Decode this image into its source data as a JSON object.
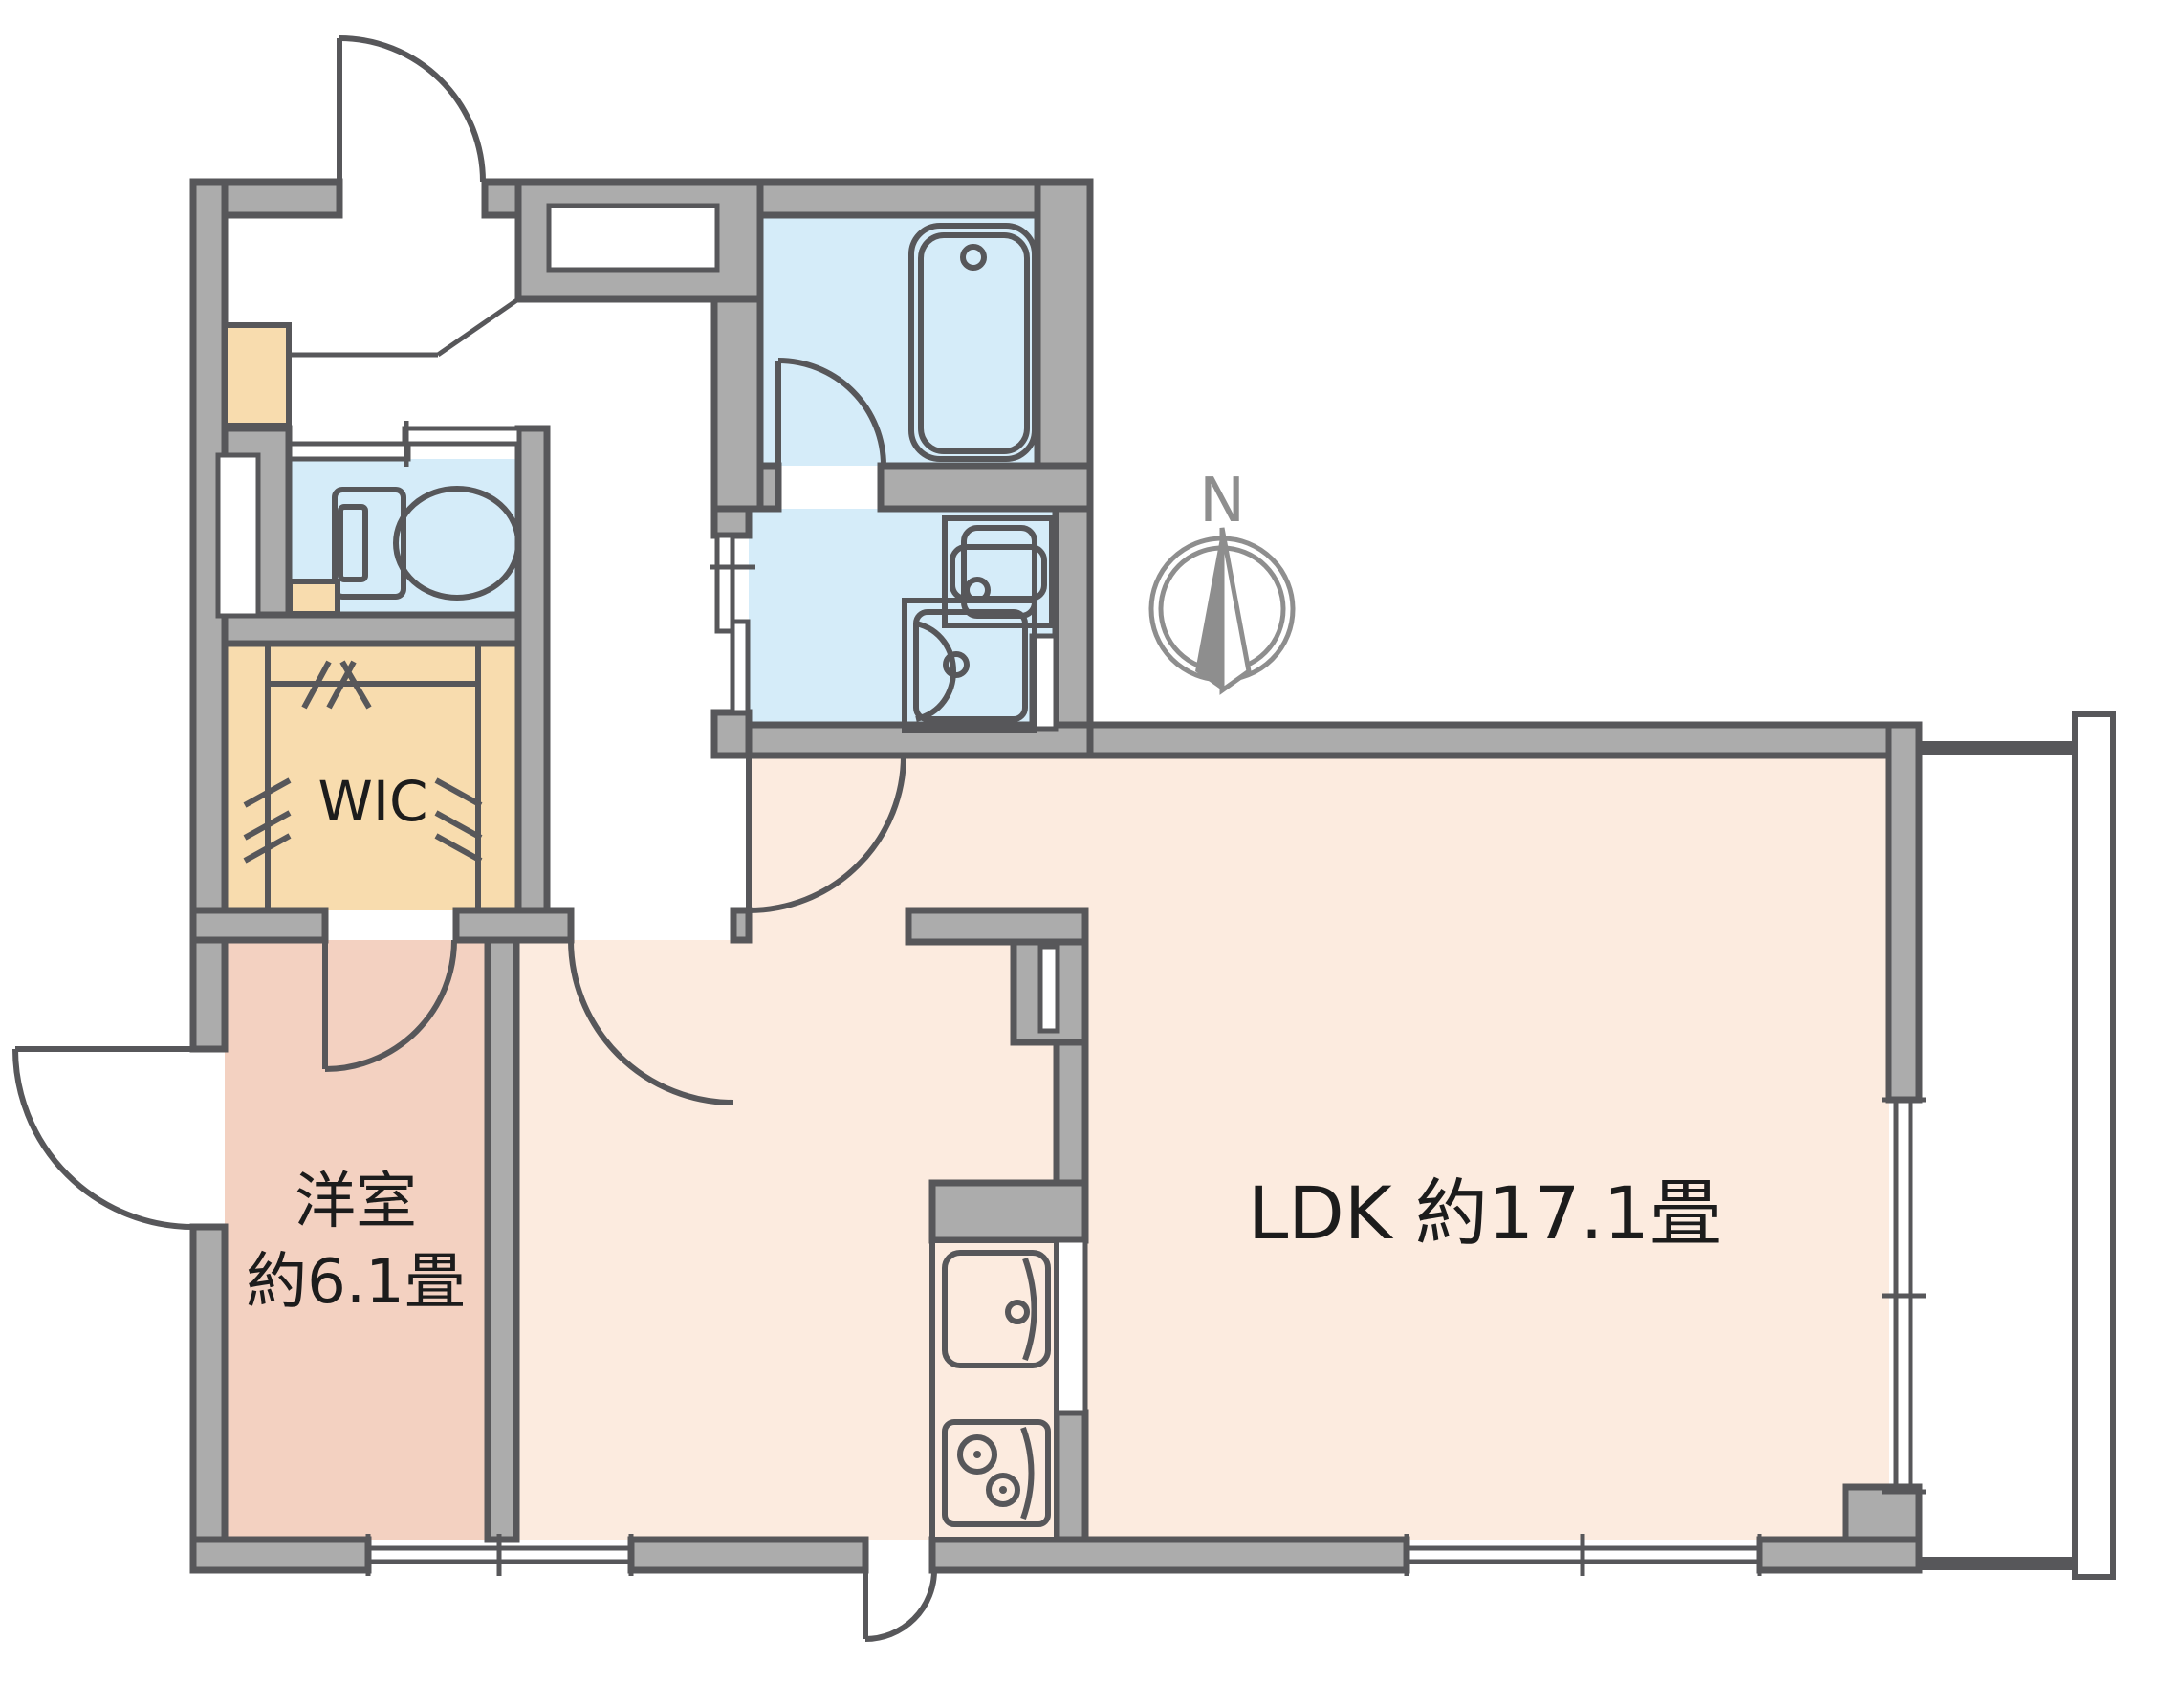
{
  "floorplan": {
    "labels": {
      "ldk": "LDK  約17.1畳",
      "western_room_line1": "洋室",
      "western_room_line2": "約6.1畳",
      "wic": "WIC",
      "compass_north": "N"
    },
    "rooms": [
      {
        "id": "ldk",
        "name": "Living Dining Kitchen",
        "label": "LDK  約17.1畳",
        "floor_color": "#fcebdf"
      },
      {
        "id": "western-room",
        "name": "Western-style room",
        "label": "洋室 約6.1畳",
        "floor_color": "#f3d1c1"
      },
      {
        "id": "wic",
        "name": "Walk-in closet",
        "label": "WIC",
        "floor_color": "#f8dcae"
      },
      {
        "id": "bathroom",
        "name": "Bathroom with tub",
        "label": "",
        "floor_color": "#d5ecf9"
      },
      {
        "id": "washroom",
        "name": "Washroom / laundry",
        "label": "",
        "floor_color": "#d5ecf9"
      },
      {
        "id": "toilet",
        "name": "Toilet",
        "label": "",
        "floor_color": "#d5ecf9"
      }
    ],
    "colors": {
      "wall_fill": "#acacac",
      "wall_line": "#57575a",
      "water_rooms": "#d5ecf9",
      "ldk_floor": "#fcebdf",
      "western_room_floor": "#f3d1c1",
      "wic_floor": "#f8dcae",
      "accent_wood": "#f8dcae",
      "label_text": "#1c1c1c",
      "compass_gray": "#8e8e8e",
      "background": "#ffffff"
    }
  }
}
